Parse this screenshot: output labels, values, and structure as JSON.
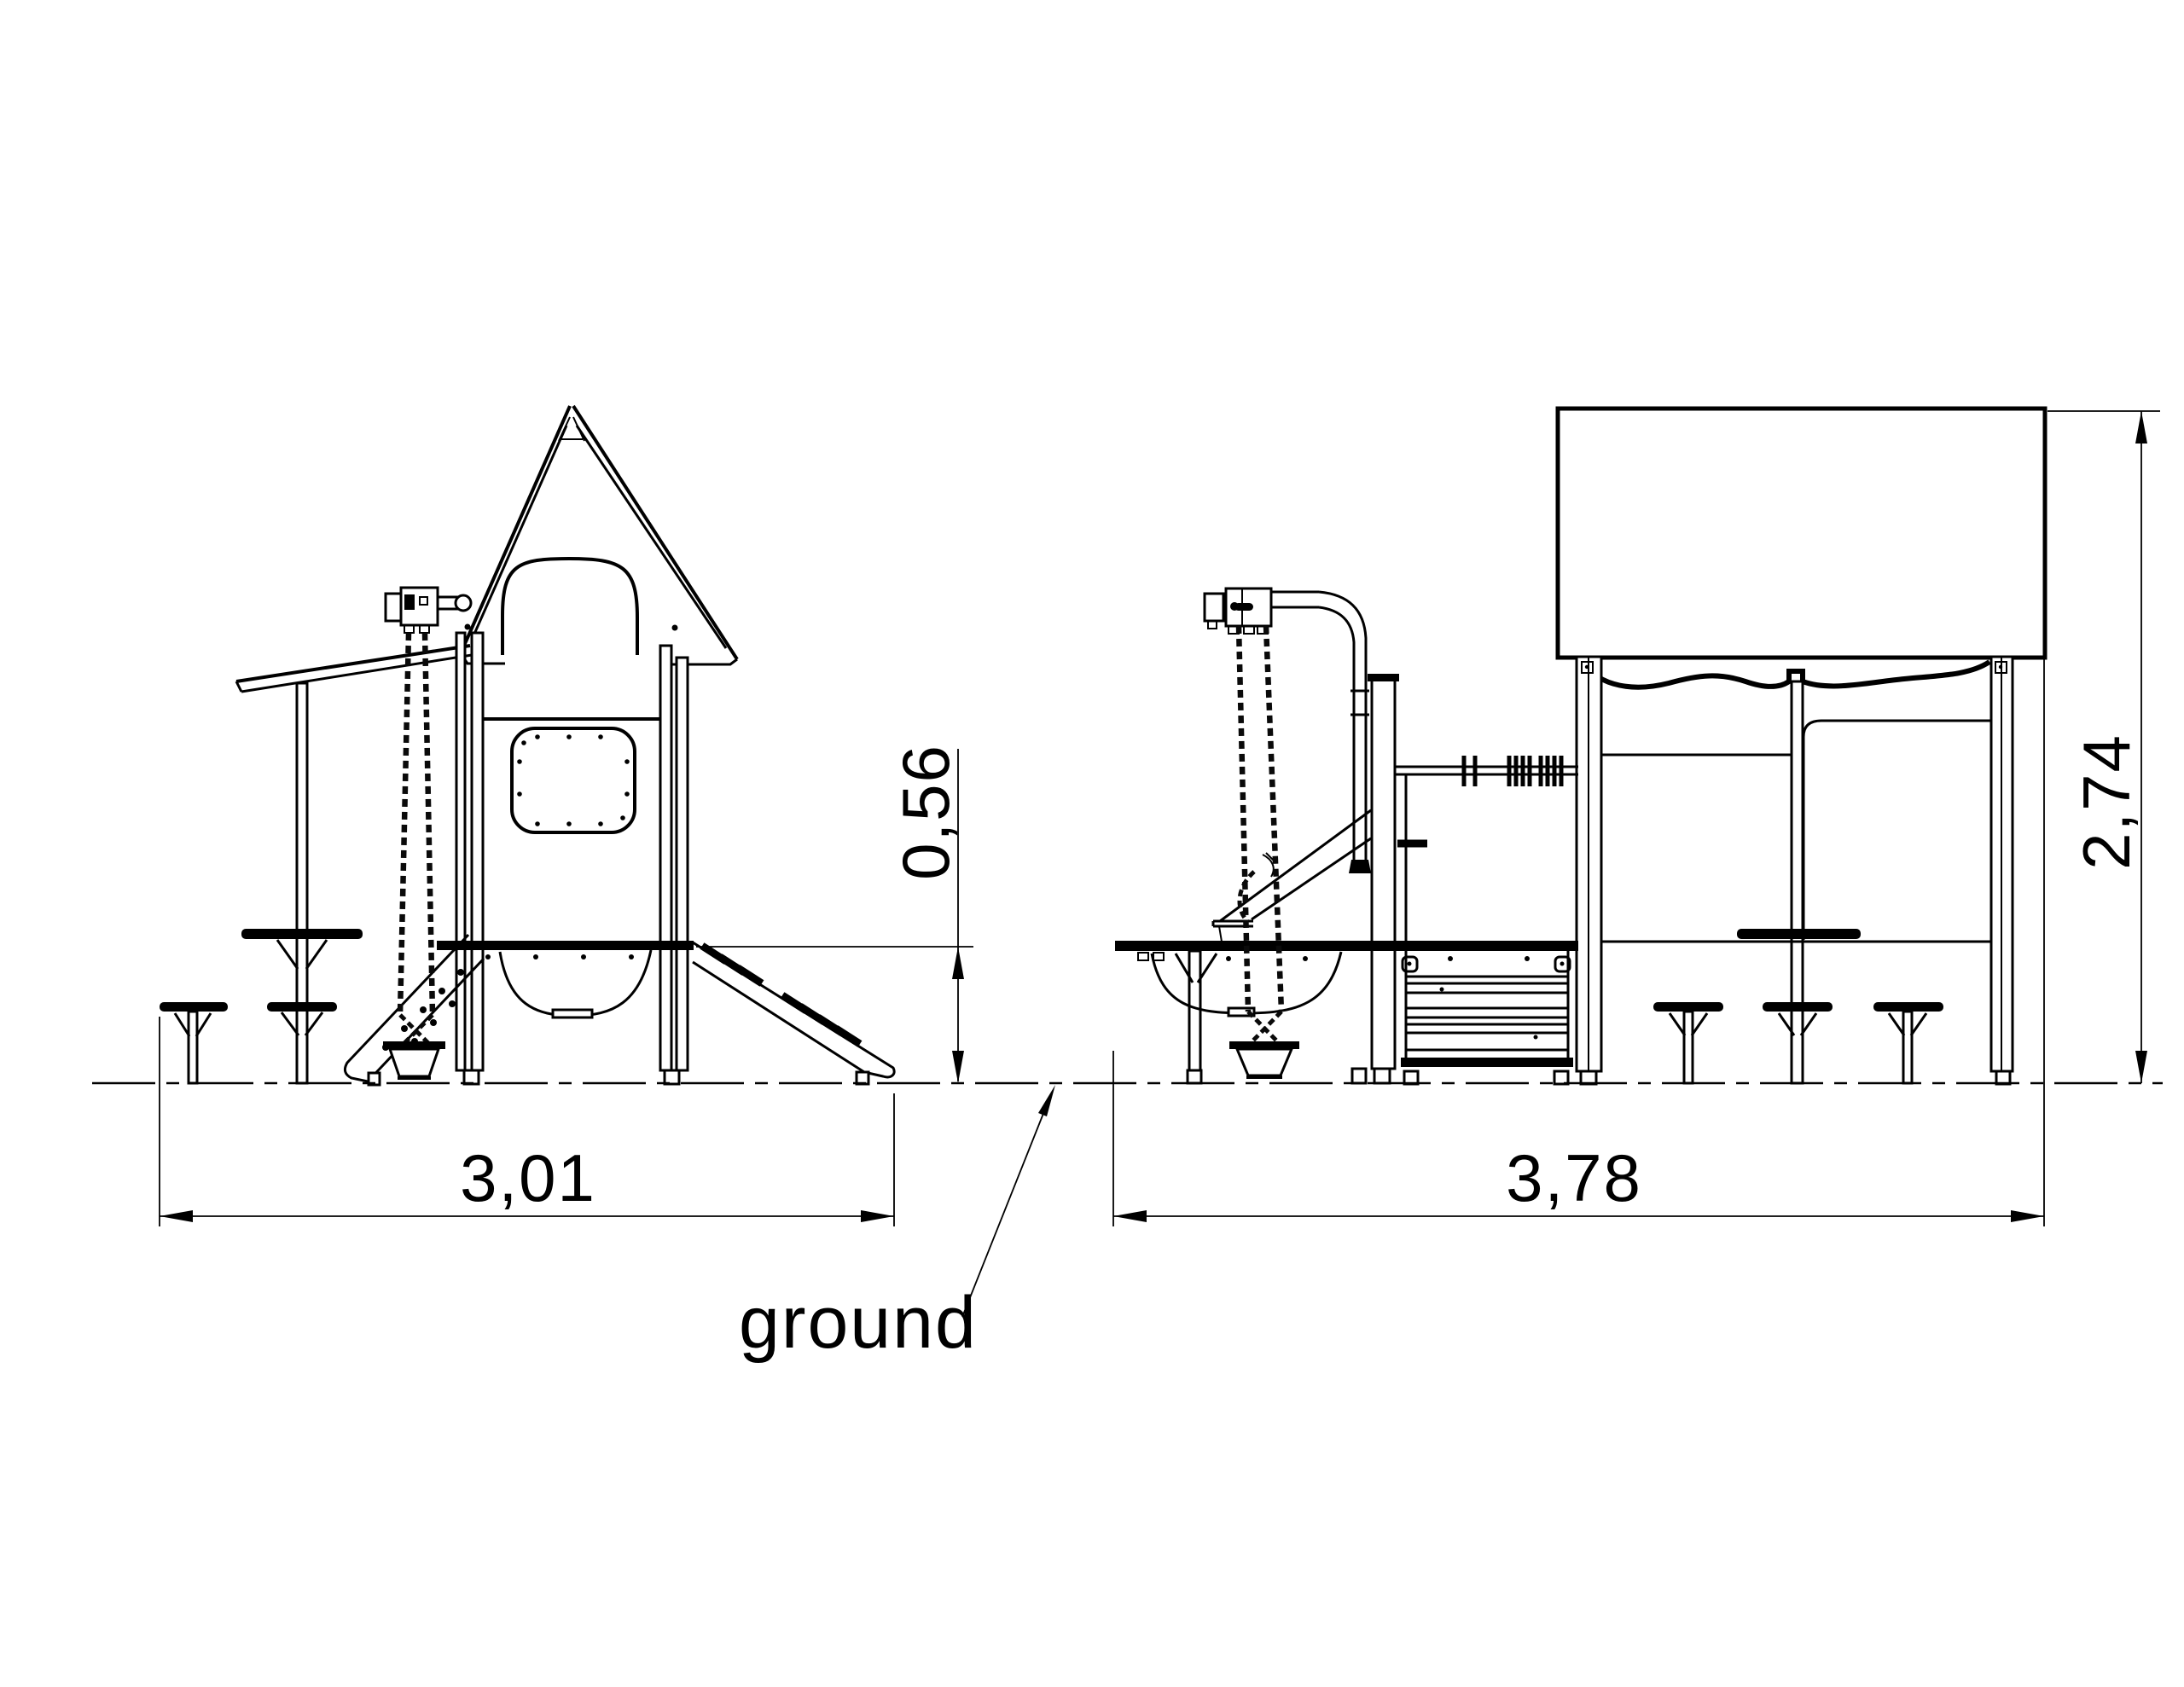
{
  "drawing": {
    "type": "technical-elevation-drawing",
    "subject": "playground-structure-two-views",
    "background_color": "#ffffff",
    "line_color": "#000000"
  },
  "labels": {
    "left_width": "3,01",
    "right_width": "3,78",
    "platform_height": "0,56",
    "overall_height": "2,74",
    "ground": "ground"
  }
}
